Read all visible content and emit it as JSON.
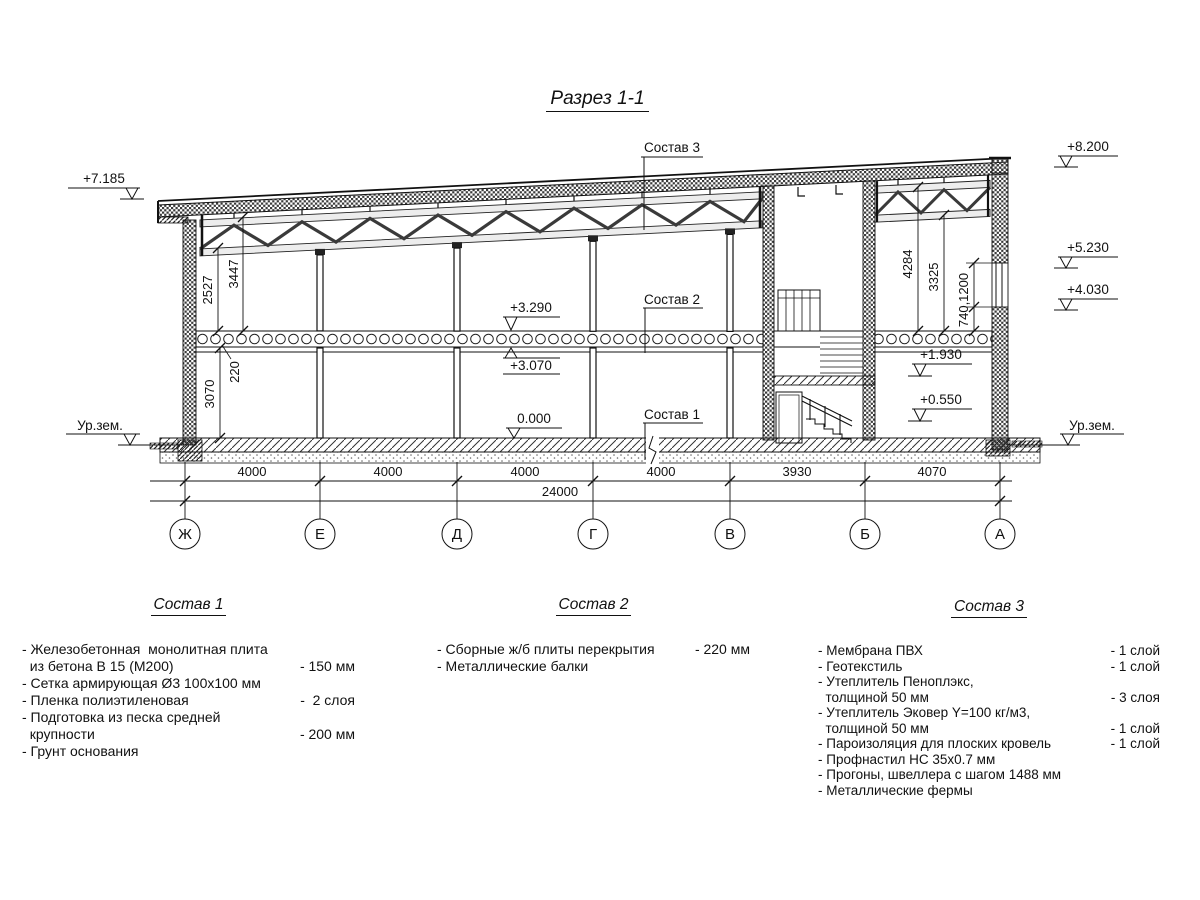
{
  "title": "Разрез 1-1",
  "callouts": {
    "c1": "Состав 1",
    "c2": "Состав 2",
    "c3": "Состав 3"
  },
  "elevations": {
    "left_roof": "+7.185",
    "right_top": "+8.200",
    "right_upper": "+5.230",
    "right_lower": "+4.030",
    "slab_top": "+3.290",
    "slab_bottom": "+3.070",
    "zero": "0.000",
    "room_upper": "+1.930",
    "room_lower": "+0.550",
    "ground_left": "Ур.зем.",
    "ground_right": "Ур.зем."
  },
  "vdims": {
    "d2527": "2527",
    "d3447": "3447",
    "d3070": "3070",
    "d220": "220",
    "d4284": "4284",
    "d3325": "3325",
    "d740_1200": "740,1200"
  },
  "axes": {
    "bubbles": [
      "Ж",
      "Е",
      "Д",
      "Г",
      "В",
      "Б",
      "А"
    ],
    "spans": [
      "4000",
      "4000",
      "4000",
      "4000",
      "3930",
      "4070"
    ],
    "total": "24000"
  },
  "compositions": [
    {
      "title": "Состав 1",
      "items": [
        {
          "text": "- Железобетонная  монолитная плита",
          "value": ""
        },
        {
          "text": "  из бетона В 15 (М200)",
          "value": "- 150 мм"
        },
        {
          "text": "- Сетка армирующая Ø3 100х100 мм",
          "value": ""
        },
        {
          "text": "- Пленка полиэтиленовая",
          "value": "-  2 слоя"
        },
        {
          "text": "- Подготовка из песка средней",
          "value": ""
        },
        {
          "text": "  крупности",
          "value": "- 200 мм"
        },
        {
          "text": "- Грунт основания",
          "value": ""
        }
      ]
    },
    {
      "title": "Состав 2",
      "items": [
        {
          "text": "- Сборные ж/б плиты перекрытия",
          "value": "- 220 мм"
        },
        {
          "text": "- Металлические балки",
          "value": ""
        }
      ]
    },
    {
      "title": "Состав 3",
      "items": [
        {
          "text": "- Мембрана ПВХ",
          "value": "- 1 слой"
        },
        {
          "text": "- Геотекстиль",
          "value": "- 1 слой"
        },
        {
          "text": "- Утеплитель Пеноплэкс,",
          "value": ""
        },
        {
          "text": "  толщиной 50 мм",
          "value": "- 3 слоя"
        },
        {
          "text": "- Утеплитель Эковер Y=100 кг/м3,",
          "value": ""
        },
        {
          "text": "  толщиной 50 мм",
          "value": "- 1 слой"
        },
        {
          "text": "- Пароизоляция для плоских кровель",
          "value": "- 1 слой"
        },
        {
          "text": "- Профнастил НС 35х0.7 мм",
          "value": ""
        },
        {
          "text": "- Прогоны, швеллера с шагом 1488 мм",
          "value": ""
        },
        {
          "text": "- Металлические фермы",
          "value": ""
        }
      ]
    }
  ]
}
